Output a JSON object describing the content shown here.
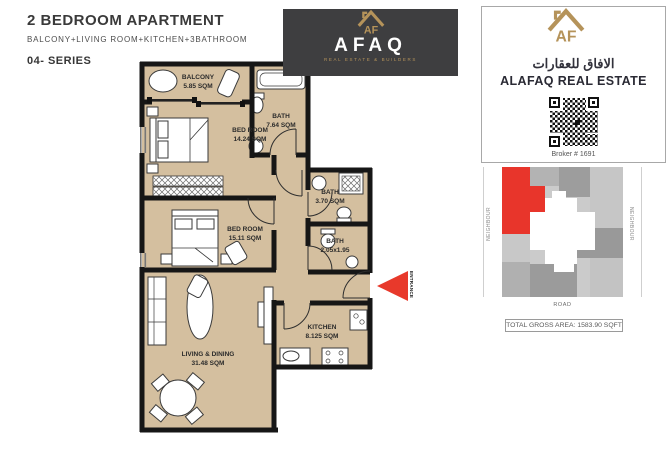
{
  "header": {
    "title": "2 BEDROOM APARTMENT",
    "subtitle": "BALCONY+LIVING ROOM+KITCHEN+3BATHROOM",
    "series": "04- SERIES"
  },
  "afaq_badge": {
    "monogram": "AF",
    "name": "AFAQ",
    "tagline": "REAL ESTATE & BUILDERS"
  },
  "alafaq_brand": {
    "monogram": "AF",
    "arabic": "الافاق للعقارات",
    "english": "ALAFAQ REAL ESTATE",
    "broker": "Broker # 1691"
  },
  "floorplan": {
    "entrance_label": "ENTRANCE",
    "rooms": [
      {
        "name": "BALCONY",
        "area": "5.85 SQM"
      },
      {
        "name": "BATH",
        "area": "7.64 SQM"
      },
      {
        "name": "BED ROOM",
        "area": "14.24 SQM"
      },
      {
        "name": "BED ROOM",
        "area": "15.11 SQM"
      },
      {
        "name": "BATH",
        "area": "3.70 SQM"
      },
      {
        "name": "BATH",
        "area": "2.05x1.95"
      },
      {
        "name": "KITCHEN",
        "area": "8.125 SQM"
      },
      {
        "name": "LIVING & DINING",
        "area": "31.48 SQM"
      }
    ]
  },
  "site_plan": {
    "neighbour_left": "NEIGHBOUR",
    "neighbour_right": "NEIGHBOUR",
    "road": "ROAD",
    "total_area": "TOTAL GROSS AREA: 1583.90 SQFT"
  },
  "colors": {
    "floor_tan": "#d4bf9f",
    "wall_black": "#161616",
    "accent_red": "#e8392b",
    "brand_gold": "#b5935a",
    "badge_dark": "#3e3e40"
  }
}
